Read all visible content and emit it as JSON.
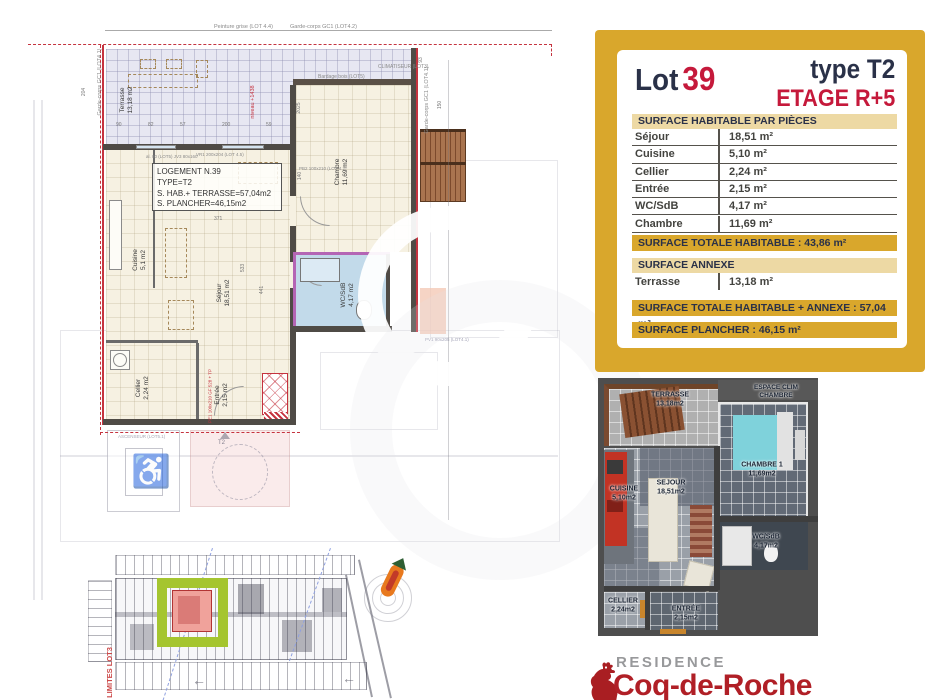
{
  "colors": {
    "gold": "#d9a72c",
    "tan": "#edd9a4",
    "navy": "#2a3148",
    "red": "#c5193b",
    "plan_red": "#c5333f",
    "logo_red": "#a91e22",
    "green_highlight": "#a5c52f",
    "wc_blue": "#c2daea",
    "terrace_lavender": "#e7e7f2",
    "room_beige": "#f6f1e2",
    "bed_cyan": "#7fd2db",
    "kitchen_red": "#c23324"
  },
  "info_panel": {
    "lot_label": "Lot",
    "lot_number": "39",
    "type_label": "type T2",
    "etage_label": "ETAGE R+5",
    "surface_header": "SURFACE HABITABLE PAR PIÈCES",
    "rooms": [
      {
        "name": "Séjour",
        "area": "18,51 m²"
      },
      {
        "name": "Cuisine",
        "area": "5,10 m²"
      },
      {
        "name": "Cellier",
        "area": "2,24 m²"
      },
      {
        "name": "Entrée",
        "area": "2,15 m²"
      },
      {
        "name": "WC/SdB",
        "area": "4,17 m²"
      },
      {
        "name": "Chambre",
        "area": "11,69 m²"
      }
    ],
    "total_habitable": "SURFACE TOTALE HABITABLE : 43,86 m²",
    "annexe_header": "SURFACE ANNEXE",
    "annexe_rooms": [
      {
        "name": "Terrasse",
        "area": "13,18 m²"
      }
    ],
    "total_habitable_annexe": "SURFACE TOTALE HABITABLE + ANNEXE : 57,04 m²",
    "surface_plancher": "SURFACE PLANCHER : 46,15 m²"
  },
  "floor_plan": {
    "logement_box": {
      "line1": "LOGEMENT N.39",
      "line2": "TYPE=T2",
      "line3": "S. HAB.+ TERRASSE=57,04m2",
      "line4": "S. PLANCHER=46,15m2"
    },
    "room_labels": [
      {
        "name": "Terrasse",
        "area": "13,18 m2"
      },
      {
        "name": "Chambre",
        "area": "11,69 m2"
      },
      {
        "name": "Cuisine",
        "area": "5,1 m2"
      },
      {
        "name": "Séjour",
        "area": "18,51 m2"
      },
      {
        "name": "WC/SdB",
        "area": "4,17 m2"
      },
      {
        "name": "Cellier",
        "area": "2,24 m2"
      },
      {
        "name": "Entrée",
        "area": "2,15 m2"
      }
    ],
    "annotations": {
      "peinture": "Peinture grise (LOT 4.4)",
      "garde_corps_top": "Garde-corps GC1 (LOT4.2)",
      "garde_corps_left": "Garde-corps GC1 (LOT4.1)",
      "garde_corps_right": "Garde-corps GC1 (LOT4.1)",
      "bardage": "Bardage bois (LOT5)",
      "clim": "CLIMATISEUR (LOT3)",
      "niveau": "niveau +1438",
      "vr1": "VR1 200x204 (LOT 4.5)",
      "pb2": "PB2 100x210 (LOT 4.2)",
      "pe1": "PE1 100x210 GF 528 + TP",
      "al80": "al. 80 (LOT5) JV3 80x160",
      "pv1": "PV1 90x205 (LOT4.1)"
    },
    "underlay": {
      "t2": "T2",
      "ascenseur": "ASCENSEUR (LOT5.1)",
      "wheelchair_icon": "♿"
    },
    "dims": [
      "204",
      "90",
      "82",
      "57",
      "200",
      "59",
      "2025",
      "140",
      "371",
      "93",
      "150",
      "533",
      "441"
    ]
  },
  "plan3d": {
    "labels": [
      {
        "name": "TERRASSE",
        "area": "13,18m2"
      },
      {
        "name": "ESPACE CLIM",
        "area": "CHAMBRE"
      },
      {
        "name": "CHAMBRE 1",
        "area": "11,69m2"
      },
      {
        "name": "CUISINE",
        "area": "5,10m2"
      },
      {
        "name": "SEJOUR",
        "area": "18,51m2"
      },
      {
        "name": "WC/SdB",
        "area": "4,17m2"
      },
      {
        "name": "CELLIER",
        "area": "2,24m2"
      },
      {
        "name": "ENTRÉE",
        "area": "2,15m2"
      }
    ]
  },
  "site_plan": {
    "limites": "LIMITES LOT3",
    "arrow": "←"
  },
  "logo": {
    "residence": "RESIDENCE",
    "name": "Coq-de-Roche"
  }
}
